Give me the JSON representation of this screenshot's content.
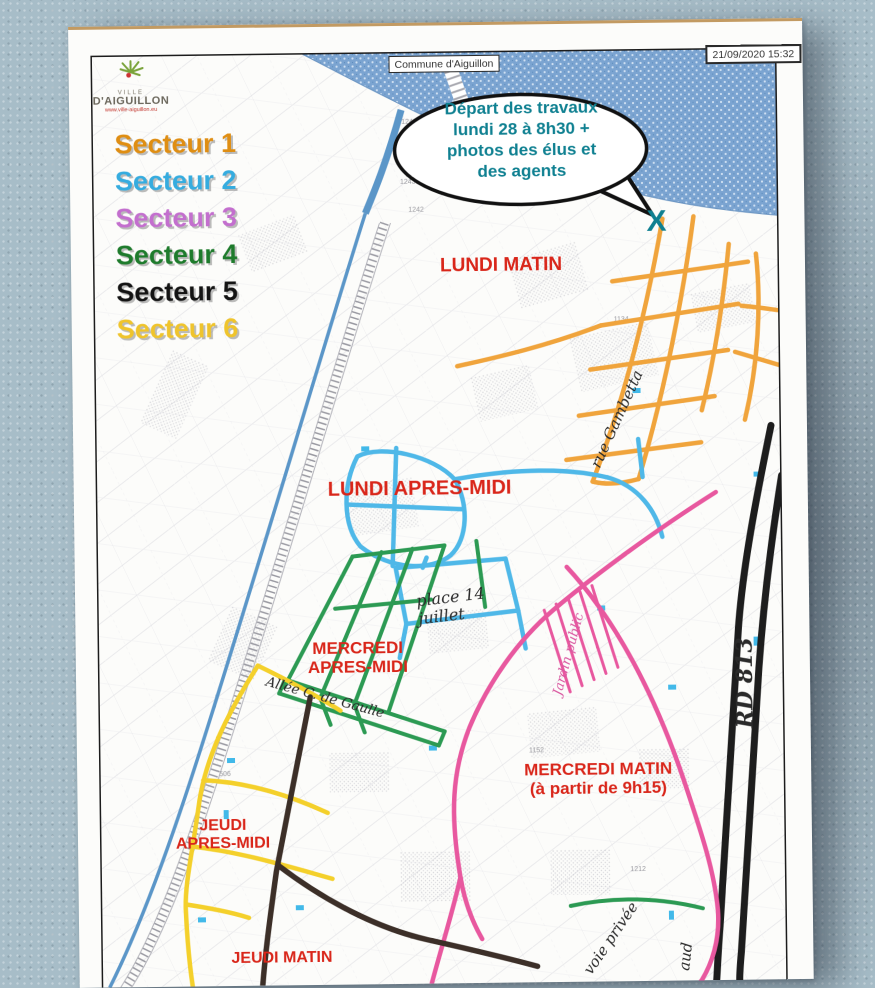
{
  "window": {
    "width": 875,
    "height": 976
  },
  "colors": {
    "secteur1": "#DF8E13",
    "secteur2": "#35ACDF",
    "secteur3": "#C36FCE",
    "secteur4": "#1E7B2C",
    "secteur5": "#141414",
    "secteur6": "#EFC42C",
    "route1": "#F0A43C",
    "route2": "#4FB8E8",
    "route3": "#E8589F",
    "route4": "#2C9A53",
    "route5": "#3C2F28",
    "route6": "#F4D02B",
    "rd813": "#1D1D1D",
    "canal": "#5B96C8",
    "river_base": "#7BA4D1",
    "river_dot": "#cfe0f2",
    "pool": "#42B9E9",
    "red_label": "#D9261A",
    "teal": "#0F8091",
    "handwriting": "#2A2A2A",
    "pink_hand": "#D957A0"
  },
  "header": {
    "logo_ville": "VILLE",
    "logo_name": "D'AIGUILLON",
    "logo_url": "www.ville-aiguillon.eu",
    "map_box_label": "Commune d'Aiguillon",
    "timestamp": "21/09/2020 15:32"
  },
  "legend": {
    "items": [
      {
        "label": "Secteur 1"
      },
      {
        "label": "Secteur 2"
      },
      {
        "label": "Secteur 3"
      },
      {
        "label": "Secteur 4"
      },
      {
        "label": "Secteur 5"
      },
      {
        "label": "Secteur 6"
      }
    ]
  },
  "bubble": {
    "line1": "Départ des travaux",
    "line2": "lundi 28 à 8h30 +",
    "line3": "photos des élus et",
    "line4": "des agents",
    "marker": "X"
  },
  "schedule": {
    "lundi_matin": "LUNDI MATIN",
    "lundi_apres_midi": "LUNDI APRES-MIDI",
    "mercredi_apm_1": "MERCREDI",
    "mercredi_apm_2": "APRES-MIDI",
    "mercredi_matin_1": "MERCREDI MATIN",
    "mercredi_matin_2": "(à partir de 9h15)",
    "jeudi_apm_1": "JEUDI",
    "jeudi_apm_2": "APRES-MIDI",
    "jeudi_matin": "JEUDI MATIN"
  },
  "handwriting": {
    "rue_gambetta": "rue Gambetta",
    "place_14": "place 14",
    "juillet": "juillet",
    "allee": "Allée C. de Gaulle",
    "rd813": "RD 813",
    "jardin_public": "Jardin public",
    "voie_privee": "voie privée",
    "fragment": "aud"
  },
  "parcels": [
    "1246",
    "1244",
    "1243",
    "1242",
    "1134",
    "1152",
    "506",
    "1212"
  ]
}
